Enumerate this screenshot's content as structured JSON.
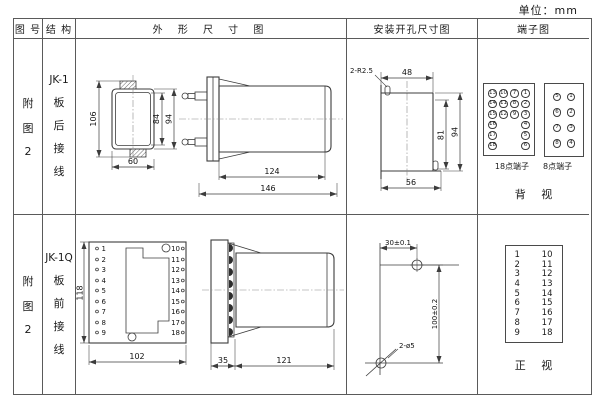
{
  "unit_label": "单位：mm",
  "headers": {
    "fig_no": "图 号",
    "structure": "结 构",
    "outline": "外 形 尺 寸 图",
    "mounting": "安装开孔尺寸图",
    "terminal": "端子图"
  },
  "row1": {
    "fig_no": [
      "附",
      "图",
      "2"
    ],
    "model": "JK-1",
    "wiring": [
      "板",
      "后",
      "接",
      "线"
    ],
    "outline": {
      "front": {
        "height_overall": "106",
        "height_inner": "84",
        "height_outer": "94",
        "width": "60"
      },
      "side": {
        "body_len": "124",
        "total_len": "146"
      }
    },
    "mounting": {
      "notch": "2-R2.5",
      "top_width": "48",
      "height_inner": "81",
      "height_outer": "94",
      "bottom_width": "56"
    },
    "terminals": {
      "grid18": [
        [
          "13",
          "10",
          "7",
          "1"
        ],
        [
          "14",
          "11",
          "8",
          "2"
        ],
        [
          "15",
          "12",
          "9",
          "3"
        ],
        [
          "16",
          "",
          "",
          "4"
        ],
        [
          "17",
          "",
          "",
          "5"
        ],
        [
          "18",
          "",
          "",
          "6"
        ]
      ],
      "grid8": [
        [
          "5",
          "1"
        ],
        [
          "6",
          "2"
        ],
        [
          "7",
          "3"
        ],
        [
          "8",
          "4"
        ]
      ],
      "label18": "18点端子",
      "label8": "8点端子",
      "view": "背 视"
    }
  },
  "row2": {
    "fig_no": [
      "附",
      "图",
      "2"
    ],
    "model": "JK-1Q",
    "wiring": [
      "板",
      "前",
      "接",
      "线"
    ],
    "outline": {
      "front": {
        "height": "118",
        "width": "102",
        "left_terminals": [
          "1",
          "2",
          "3",
          "4",
          "5",
          "6",
          "7",
          "8",
          "9"
        ],
        "right_terminals": [
          "10",
          "11",
          "12",
          "13",
          "14",
          "15",
          "16",
          "17",
          "18"
        ]
      },
      "side": {
        "flange_depth": "35",
        "body_len": "121"
      }
    },
    "mounting": {
      "hole_offset": "30±0.1",
      "hole_spacing": "100±0.2",
      "holes": "2-ø5"
    },
    "terminals": {
      "left": [
        "1",
        "2",
        "3",
        "4",
        "5",
        "6",
        "7",
        "8",
        "9"
      ],
      "right": [
        "10",
        "11",
        "12",
        "13",
        "14",
        "15",
        "16",
        "17",
        "18"
      ],
      "view": "正 视"
    }
  }
}
